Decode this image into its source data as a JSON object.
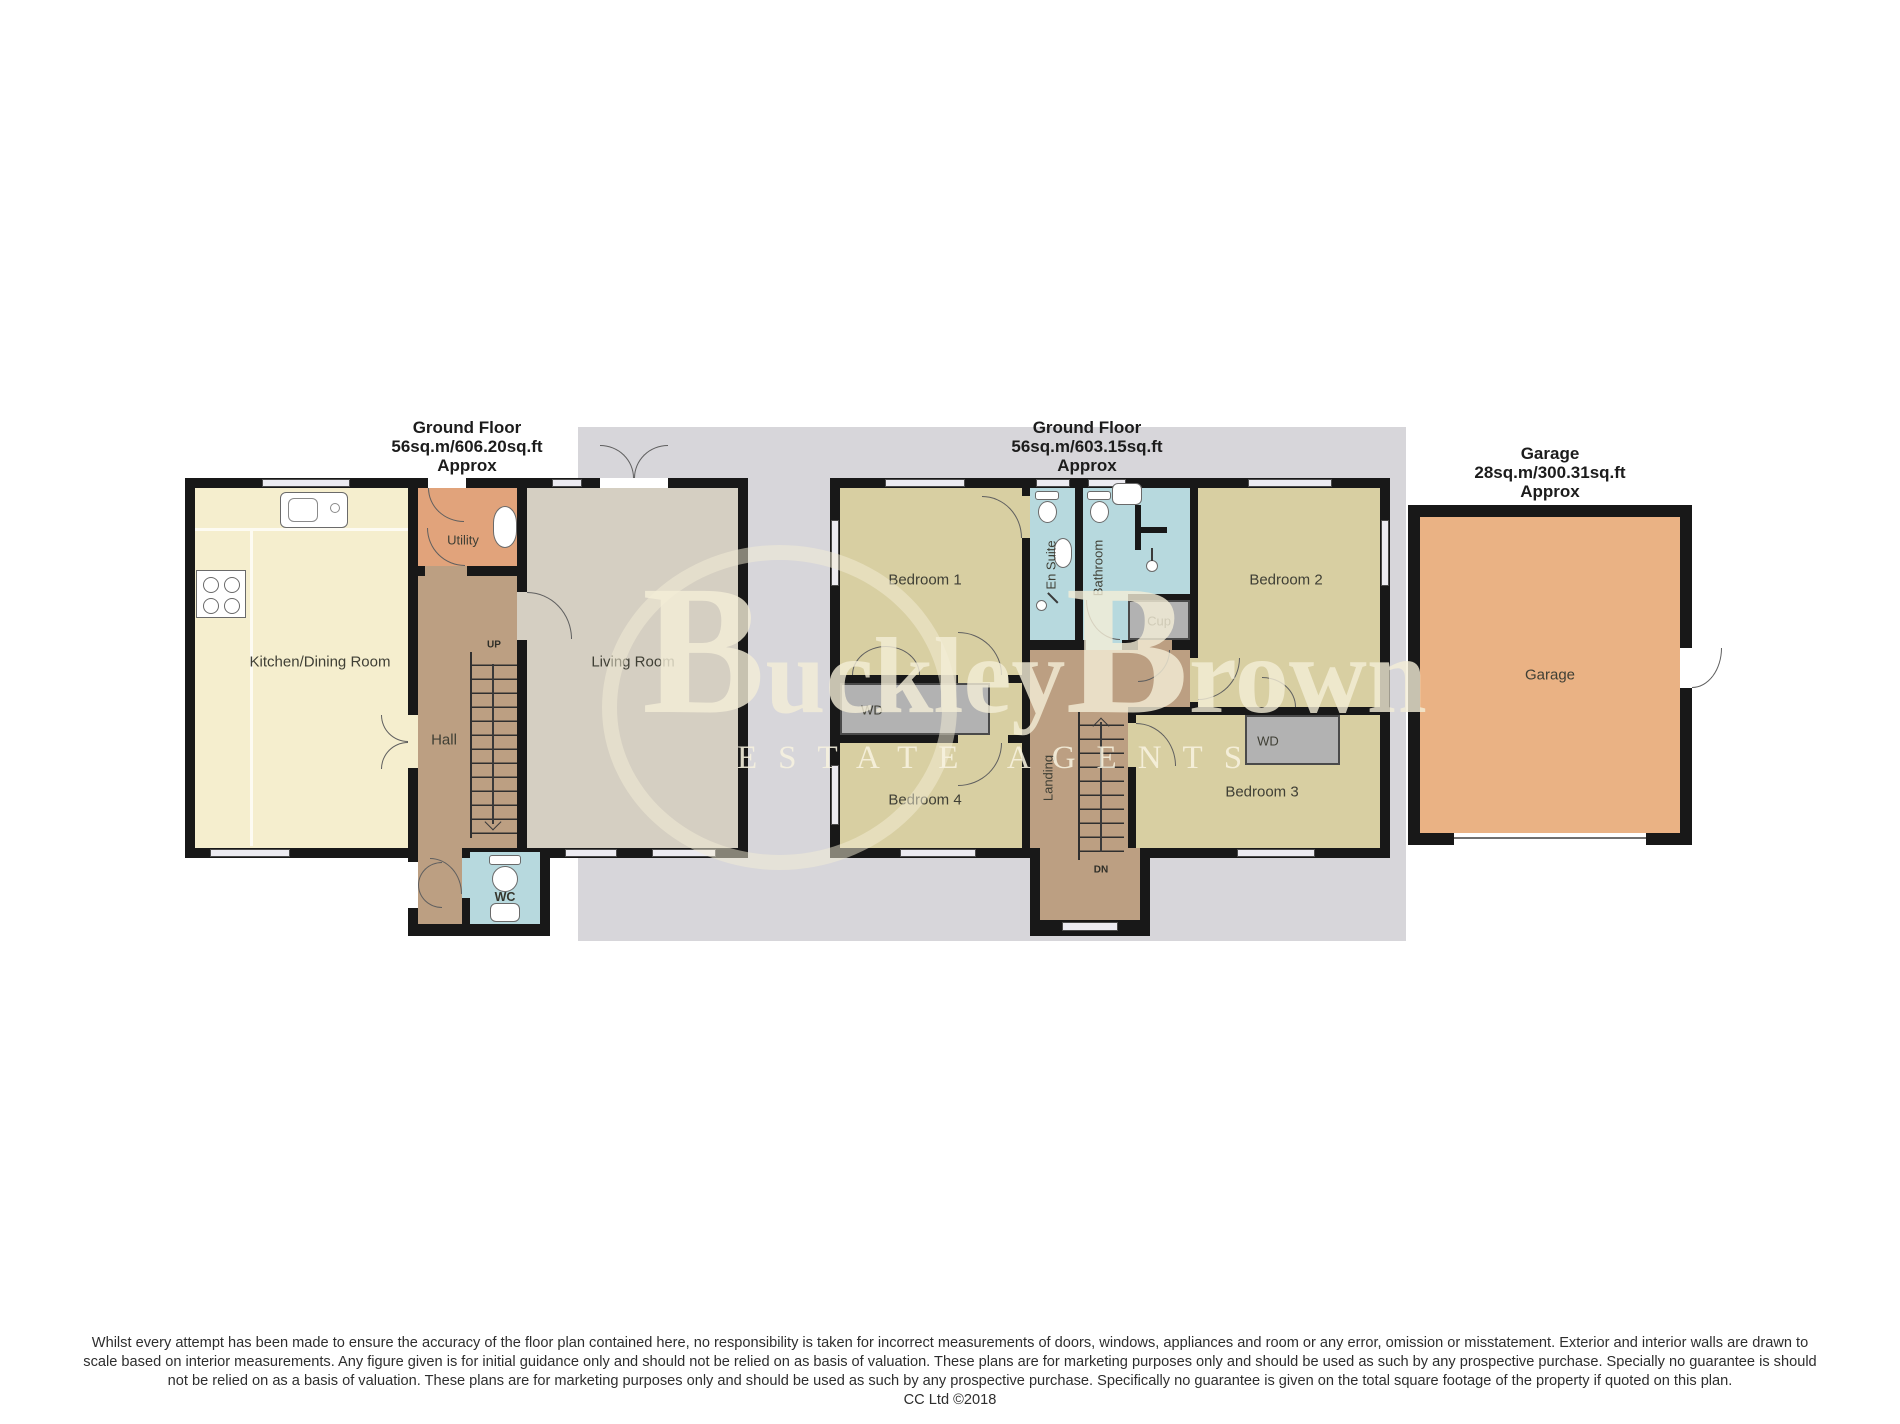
{
  "plans": {
    "left": {
      "title1": "Ground Floor",
      "title2": "56sq.m/606.20sq.ft",
      "title3": "Approx",
      "rooms": {
        "kitchen": "Kitchen/Dining Room",
        "utility": "Utility",
        "hall": "Hall",
        "living": "Living Room",
        "wc": "WC"
      },
      "stairs_label": "UP"
    },
    "middle": {
      "title1": "Ground Floor",
      "title2": "56sq.m/603.15sq.ft",
      "title3": "Approx",
      "rooms": {
        "bedroom1": "Bedroom 1",
        "ensuite": "En Suite",
        "bathroom": "Bathroom",
        "cup": "Cup",
        "bedroom2": "Bedroom 2",
        "wd_left": "WD",
        "wd_right": "WD",
        "bedroom4": "Bedroom 4",
        "landing": "Landing",
        "bedroom3": "Bedroom 3"
      },
      "stairs_label": "DN"
    },
    "garage": {
      "title1": "Garage",
      "title2": "28sq.m/300.31sq.ft",
      "title3": "Approx",
      "rooms": {
        "garage": "Garage"
      }
    }
  },
  "watermark": {
    "b1": "B",
    "p1": "uckley",
    "b2": "B",
    "p2": "rown",
    "tagline": "ESTATE AGENTS"
  },
  "disclaimer": {
    "l1": "Whilst every attempt has been made to ensure the accuracy of the floor plan contained here, no responsibility is taken for incorrect measurements of doors, windows, appliances and room or any error, omission or misstatement. Exterior and interior walls are drawn to",
    "l2": "scale based on interior measurements. Any figure given is for initial guidance only and should not be relied on as basis of valuation. These plans are for marketing purposes only and should be used as such by any prospective purchase. Specially no guarantee is should",
    "l3": "not be relied on as a basis of valuation. These plans are for marketing purposes only and should be used as such by any prospective purchase. Specifically no guarantee is given on the total square footage of the property if quoted on this plan.",
    "l4": "CC Ltd ©2018"
  },
  "colors": {
    "wall": "#181818",
    "kitchen": "#f5eece",
    "utility": "#e1a37b",
    "hall_landing": "#bc9f82",
    "wet_room_blue": "#b7d9de",
    "living": "#d5cfc2",
    "bedroom_khaki": "#d8cfa2",
    "closet_grey": "#b2b2b2",
    "garage": "#eab284",
    "backdrop_grey": "#d7d6da",
    "watermark_cream": "#f3edd6"
  }
}
